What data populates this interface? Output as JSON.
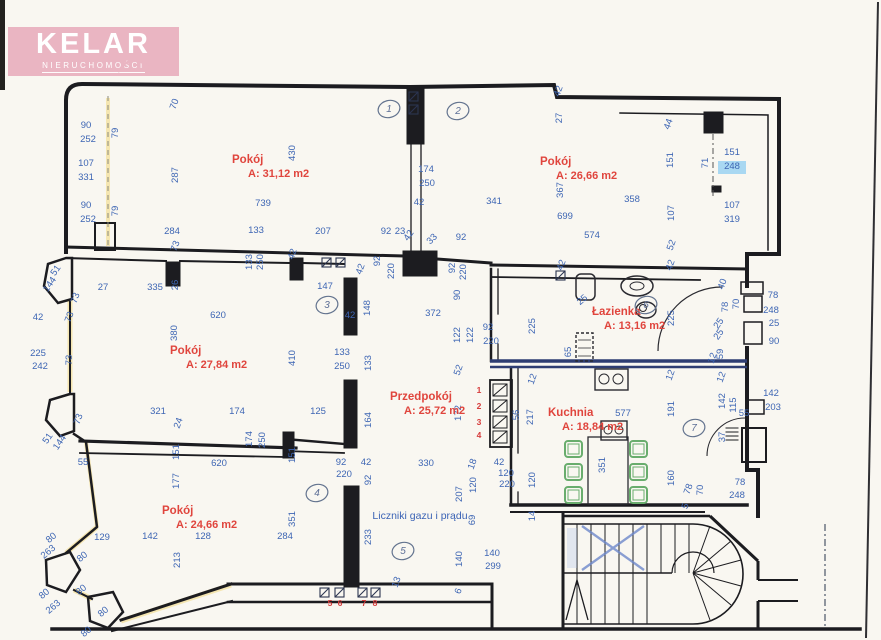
{
  "logo": {
    "brand": "KELAR",
    "subtitle": "NIERUCHOMOŚCI",
    "bg": "#eab5c2",
    "fg": "#ffffff"
  },
  "colors": {
    "paper": "#f9f7f1",
    "wall": "#1c1c20",
    "dimension_blue": "#3e66b4",
    "room_red": "#e0453d",
    "navy_wall": "#2e3d72",
    "chair_green": "#69ad6d",
    "marker_blue": "#8ecdf2",
    "marker_yellow": "#f2d87c"
  },
  "note": {
    "text": "Liczniki gazu i prądu",
    "x": 420,
    "y": 519
  },
  "rooms": [
    {
      "name": "Pokój",
      "area": "A: 31,12 m2",
      "nx": 232,
      "ny": 163,
      "ax": 248,
      "ay": 177
    },
    {
      "name": "Pokój",
      "area": "A: 26,66 m2",
      "nx": 540,
      "ny": 165,
      "ax": 556,
      "ay": 179
    },
    {
      "name": "Pokój",
      "area": "A: 27,84 m2",
      "nx": 170,
      "ny": 354,
      "ax": 186,
      "ay": 368
    },
    {
      "name": "Przedpokój",
      "area": "A: 25,72 m2",
      "nx": 390,
      "ny": 400,
      "ax": 404,
      "ay": 414
    },
    {
      "name": "Łazienka",
      "area": "A: 13,16 m2",
      "nx": 592,
      "ny": 315,
      "ax": 604,
      "ay": 329
    },
    {
      "name": "Kuchnia",
      "area": "A: 18,84 m2",
      "nx": 548,
      "ny": 416,
      "ax": 562,
      "ay": 430
    },
    {
      "name": "Pokój",
      "area": "A: 24,66 m2",
      "nx": 162,
      "ny": 514,
      "ax": 176,
      "ay": 528
    }
  ],
  "highlight": {
    "value": "248",
    "x": 718,
    "y": 161,
    "w": 28,
    "h": 13,
    "color": "#8ecdf2"
  },
  "meter_numbers": [
    [
      "1",
      479,
      393
    ],
    [
      "2",
      479,
      409
    ],
    [
      "3",
      479,
      425
    ],
    [
      "4",
      479,
      438
    ],
    [
      "5",
      330,
      606
    ],
    [
      "6",
      340,
      606
    ],
    [
      "7",
      364,
      606
    ],
    [
      "8",
      375,
      606
    ]
  ],
  "circled_numbers": [
    [
      "1",
      389,
      112
    ],
    [
      "2",
      458,
      114
    ],
    [
      "3",
      327,
      308
    ],
    [
      "4",
      317,
      496
    ],
    [
      "5",
      403,
      554
    ],
    [
      "6",
      646,
      308
    ],
    [
      "7",
      694,
      431
    ]
  ],
  "dimensions": [
    [
      "90",
      86,
      128
    ],
    [
      "252",
      88,
      142
    ],
    [
      "107",
      86,
      166
    ],
    [
      "331",
      86,
      180
    ],
    [
      "90",
      86,
      208
    ],
    [
      "252",
      88,
      222
    ],
    [
      "79",
      118,
      133,
      -90
    ],
    [
      "79",
      118,
      211,
      -90
    ],
    [
      "70",
      177,
      105,
      -70
    ],
    [
      "287",
      178,
      175,
      -90
    ],
    [
      "430",
      295,
      153,
      -90
    ],
    [
      "739",
      263,
      206
    ],
    [
      "284",
      172,
      234
    ],
    [
      "73",
      178,
      247,
      -70
    ],
    [
      "133",
      256,
      233
    ],
    [
      "207",
      323,
      234
    ],
    [
      "133",
      252,
      262,
      -90
    ],
    [
      "250",
      263,
      262,
      -90
    ],
    [
      "42",
      295,
      255,
      -70
    ],
    [
      "92",
      386,
      234
    ],
    [
      "23",
      400,
      234
    ],
    [
      "42",
      411,
      237,
      -55
    ],
    [
      "33",
      434,
      241,
      -45
    ],
    [
      "92",
      461,
      240
    ],
    [
      "92",
      380,
      261,
      -90
    ],
    [
      "220",
      394,
      271,
      -90
    ],
    [
      "42",
      363,
      270,
      -70
    ],
    [
      "92",
      455,
      268,
      -90
    ],
    [
      "220",
      466,
      272,
      -90
    ],
    [
      "90",
      460,
      295,
      -90
    ],
    [
      "42",
      561,
      92,
      -70
    ],
    [
      "27",
      562,
      118,
      -90
    ],
    [
      "174",
      426,
      172
    ],
    [
      "250",
      427,
      186
    ],
    [
      "42",
      419,
      205
    ],
    [
      "341",
      494,
      204
    ],
    [
      "367",
      563,
      190,
      -90
    ],
    [
      "699",
      565,
      219
    ],
    [
      "574",
      592,
      238
    ],
    [
      "358",
      632,
      202
    ],
    [
      "44",
      671,
      125,
      -70
    ],
    [
      "151",
      673,
      160,
      -90
    ],
    [
      "71",
      708,
      163,
      -90
    ],
    [
      "151",
      732,
      155
    ],
    [
      "248",
      732,
      169
    ],
    [
      "107",
      674,
      213,
      -90
    ],
    [
      "107",
      732,
      208
    ],
    [
      "319",
      732,
      222
    ],
    [
      "52",
      674,
      246,
      -70
    ],
    [
      "51",
      58,
      272,
      -55
    ],
    [
      "144",
      52,
      286,
      -55
    ],
    [
      "27",
      103,
      290
    ],
    [
      "73",
      78,
      299,
      -70
    ],
    [
      "335",
      155,
      290
    ],
    [
      "26",
      178,
      285,
      -90
    ],
    [
      "42",
      38,
      320
    ],
    [
      "73",
      72,
      318,
      -70
    ],
    [
      "620",
      218,
      318
    ],
    [
      "225",
      38,
      356
    ],
    [
      "242",
      40,
      369
    ],
    [
      "73",
      72,
      360,
      -90
    ],
    [
      "380",
      177,
      333,
      -90
    ],
    [
      "410",
      295,
      358,
      -90
    ],
    [
      "321",
      158,
      414
    ],
    [
      "174",
      237,
      414
    ],
    [
      "24",
      181,
      424,
      -70
    ],
    [
      "73",
      81,
      420,
      -70
    ],
    [
      "51",
      50,
      440,
      -55
    ],
    [
      "144",
      62,
      444,
      -55
    ],
    [
      "174",
      252,
      439,
      -90
    ],
    [
      "250",
      265,
      440,
      -90
    ],
    [
      "151",
      179,
      452,
      -90
    ],
    [
      "151",
      295,
      455,
      -90
    ],
    [
      "147",
      325,
      289
    ],
    [
      "42",
      350,
      318
    ],
    [
      "148",
      370,
      308,
      -90
    ],
    [
      "372",
      433,
      316
    ],
    [
      "133",
      342,
      355
    ],
    [
      "250",
      342,
      369
    ],
    [
      "133",
      371,
      363,
      -90
    ],
    [
      "122",
      460,
      335,
      -90
    ],
    [
      "122",
      473,
      335,
      -90
    ],
    [
      "92",
      488,
      330
    ],
    [
      "220",
      491,
      344
    ],
    [
      "52",
      461,
      371,
      -70
    ],
    [
      "172",
      461,
      413,
      -90
    ],
    [
      "125",
      318,
      414
    ],
    [
      "164",
      371,
      420,
      -90
    ],
    [
      "92",
      341,
      465
    ],
    [
      "220",
      344,
      477
    ],
    [
      "42",
      366,
      465
    ],
    [
      "92",
      371,
      480,
      -90
    ],
    [
      "330",
      426,
      466
    ],
    [
      "207",
      462,
      494,
      -90
    ],
    [
      "120",
      476,
      485,
      -90
    ],
    [
      "18",
      475,
      465,
      -70
    ],
    [
      "42",
      499,
      465
    ],
    [
      "120",
      506,
      476
    ],
    [
      "220",
      507,
      487
    ],
    [
      "120",
      535,
      480,
      -90
    ],
    [
      "69",
      475,
      520,
      -90
    ],
    [
      "233",
      371,
      537,
      -90
    ],
    [
      "140",
      462,
      559,
      -90
    ],
    [
      "140",
      492,
      556
    ],
    [
      "299",
      493,
      569
    ],
    [
      "13",
      399,
      583,
      -70
    ],
    [
      "6",
      461,
      592,
      -70
    ],
    [
      "14",
      535,
      516,
      -90
    ],
    [
      "42",
      564,
      266,
      -70
    ],
    [
      "25",
      584,
      302,
      -40
    ],
    [
      "225",
      535,
      326,
      -90
    ],
    [
      "225",
      674,
      318,
      -90
    ],
    [
      "42",
      673,
      266,
      -70
    ],
    [
      "65",
      571,
      352,
      -90
    ],
    [
      "12",
      535,
      380,
      -70
    ],
    [
      "12",
      673,
      376,
      -70
    ],
    [
      "40",
      725,
      285,
      -70
    ],
    [
      "78",
      728,
      307,
      -90
    ],
    [
      "70",
      739,
      304,
      -90
    ],
    [
      "25",
      721,
      325,
      -55
    ],
    [
      "25",
      721,
      336,
      -55
    ],
    [
      "59",
      723,
      354,
      -90
    ],
    [
      "12",
      715,
      359,
      -70
    ],
    [
      "12",
      724,
      378,
      -70
    ],
    [
      "78",
      773,
      298
    ],
    [
      "248",
      771,
      313
    ],
    [
      "25",
      774,
      326
    ],
    [
      "90",
      774,
      344
    ],
    [
      "142",
      771,
      396
    ],
    [
      "203",
      773,
      410
    ],
    [
      "55",
      744,
      416
    ],
    [
      "142",
      725,
      401,
      -90
    ],
    [
      "115",
      736,
      405,
      -90
    ],
    [
      "37",
      725,
      437,
      -90
    ],
    [
      "56",
      519,
      415,
      -90
    ],
    [
      "217",
      533,
      417,
      -90
    ],
    [
      "577",
      623,
      416
    ],
    [
      "191",
      674,
      409,
      -90
    ],
    [
      "351",
      605,
      465,
      -90
    ],
    [
      "160",
      674,
      478,
      -90
    ],
    [
      "78",
      691,
      490,
      -70
    ],
    [
      "70",
      703,
      490,
      -90
    ],
    [
      "5",
      688,
      507,
      -70
    ],
    [
      "78",
      740,
      485
    ],
    [
      "248",
      737,
      498
    ],
    [
      "55",
      83,
      465
    ],
    [
      "620",
      219,
      466
    ],
    [
      "177",
      179,
      481,
      -90
    ],
    [
      "129",
      102,
      540
    ],
    [
      "142",
      150,
      539
    ],
    [
      "128",
      203,
      539
    ],
    [
      "284",
      285,
      539
    ],
    [
      "213",
      180,
      560,
      -90
    ],
    [
      "351",
      295,
      519,
      -90
    ],
    [
      "80",
      53,
      540,
      -40
    ],
    [
      "263",
      50,
      554,
      -40
    ],
    [
      "80",
      84,
      559,
      -40
    ],
    [
      "80",
      46,
      596,
      -40
    ],
    [
      "263",
      55,
      609,
      -40
    ],
    [
      "80",
      83,
      592,
      -40
    ],
    [
      "80",
      105,
      614,
      -40
    ],
    [
      "80",
      88,
      634,
      -40
    ]
  ]
}
